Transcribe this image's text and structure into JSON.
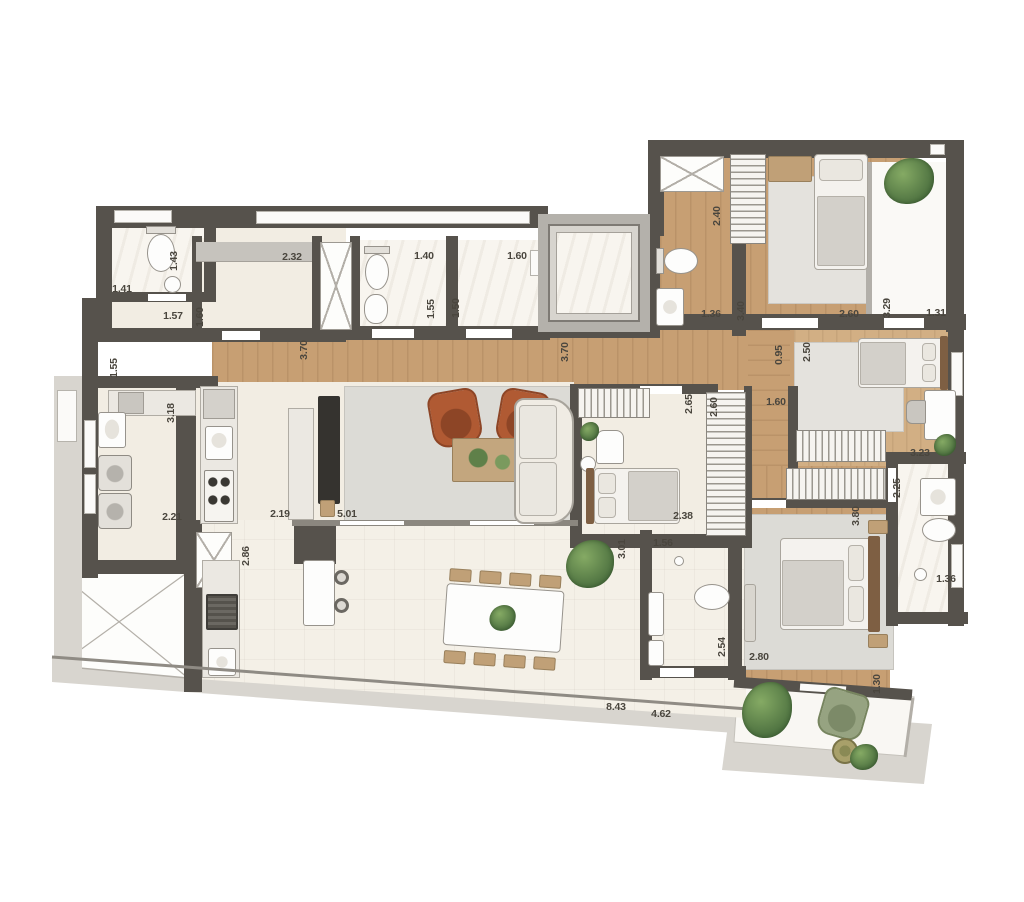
{
  "plan_title": "apartment-floor-plan",
  "palette": {
    "wall": "#56524c",
    "floor_cream": "#f2ede3",
    "floor_marble": "#f8f5ef",
    "floor_wood": "#c79f73",
    "terrace_tile": "#f4f0e7",
    "rug": "#dcdbd6",
    "deck": "#d8d5cf",
    "armchair_terracotta": "#b05a33",
    "plant_green": "#4d7140",
    "balcony_chair_sage": "#96a381",
    "dimension_text": "#4a463e"
  },
  "dimensions": [
    {
      "text": "1.41",
      "x": 122,
      "y": 289,
      "v": false
    },
    {
      "text": "1.43",
      "x": 174,
      "y": 261,
      "v": true
    },
    {
      "text": "1.57",
      "x": 173,
      "y": 316,
      "v": false
    },
    {
      "text": "1.60",
      "x": 200,
      "y": 317,
      "v": true
    },
    {
      "text": "2.32",
      "x": 292,
      "y": 257,
      "v": false
    },
    {
      "text": "1.55",
      "x": 114,
      "y": 368,
      "v": true
    },
    {
      "text": "3.70",
      "x": 304,
      "y": 350,
      "v": true
    },
    {
      "text": "1.40",
      "x": 424,
      "y": 256,
      "v": false
    },
    {
      "text": "1.55",
      "x": 431,
      "y": 309,
      "v": true
    },
    {
      "text": "1.50",
      "x": 456,
      "y": 308,
      "v": true
    },
    {
      "text": "1.60",
      "x": 517,
      "y": 256,
      "v": false
    },
    {
      "text": "3.70",
      "x": 565,
      "y": 352,
      "v": true
    },
    {
      "text": "2.40",
      "x": 717,
      "y": 216,
      "v": true
    },
    {
      "text": "1.36",
      "x": 711,
      "y": 314,
      "v": false
    },
    {
      "text": "3.40",
      "x": 741,
      "y": 311,
      "v": true
    },
    {
      "text": "2.60",
      "x": 849,
      "y": 314,
      "v": false
    },
    {
      "text": "3.29",
      "x": 887,
      "y": 308,
      "v": true
    },
    {
      "text": "1.31",
      "x": 936,
      "y": 313,
      "v": false
    },
    {
      "text": "3.18",
      "x": 171,
      "y": 413,
      "v": true
    },
    {
      "text": "2.21",
      "x": 172,
      "y": 517,
      "v": false
    },
    {
      "text": "2.19",
      "x": 280,
      "y": 514,
      "v": false
    },
    {
      "text": "5.01",
      "x": 347,
      "y": 514,
      "v": false
    },
    {
      "text": "2.86",
      "x": 246,
      "y": 556,
      "v": true
    },
    {
      "text": "2.65",
      "x": 689,
      "y": 404,
      "v": true
    },
    {
      "text": "2.60",
      "x": 714,
      "y": 407,
      "v": true
    },
    {
      "text": "0.95",
      "x": 779,
      "y": 355,
      "v": true
    },
    {
      "text": "2.50",
      "x": 807,
      "y": 352,
      "v": true
    },
    {
      "text": "1.60",
      "x": 776,
      "y": 402,
      "v": false
    },
    {
      "text": "2.38",
      "x": 683,
      "y": 516,
      "v": false
    },
    {
      "text": "1.56",
      "x": 663,
      "y": 543,
      "v": false
    },
    {
      "text": "3.01",
      "x": 622,
      "y": 549,
      "v": true
    },
    {
      "text": "3.23",
      "x": 920,
      "y": 453,
      "v": false
    },
    {
      "text": "2.25",
      "x": 897,
      "y": 488,
      "v": true
    },
    {
      "text": "1.36",
      "x": 946,
      "y": 579,
      "v": false
    },
    {
      "text": "2.54",
      "x": 722,
      "y": 647,
      "v": true
    },
    {
      "text": "2.80",
      "x": 759,
      "y": 657,
      "v": false
    },
    {
      "text": "8.43",
      "x": 616,
      "y": 707,
      "v": false
    },
    {
      "text": "4.62",
      "x": 661,
      "y": 714,
      "v": false
    },
    {
      "text": "3.80",
      "x": 856,
      "y": 516,
      "v": true
    },
    {
      "text": "1.30",
      "x": 877,
      "y": 684,
      "v": true
    }
  ]
}
